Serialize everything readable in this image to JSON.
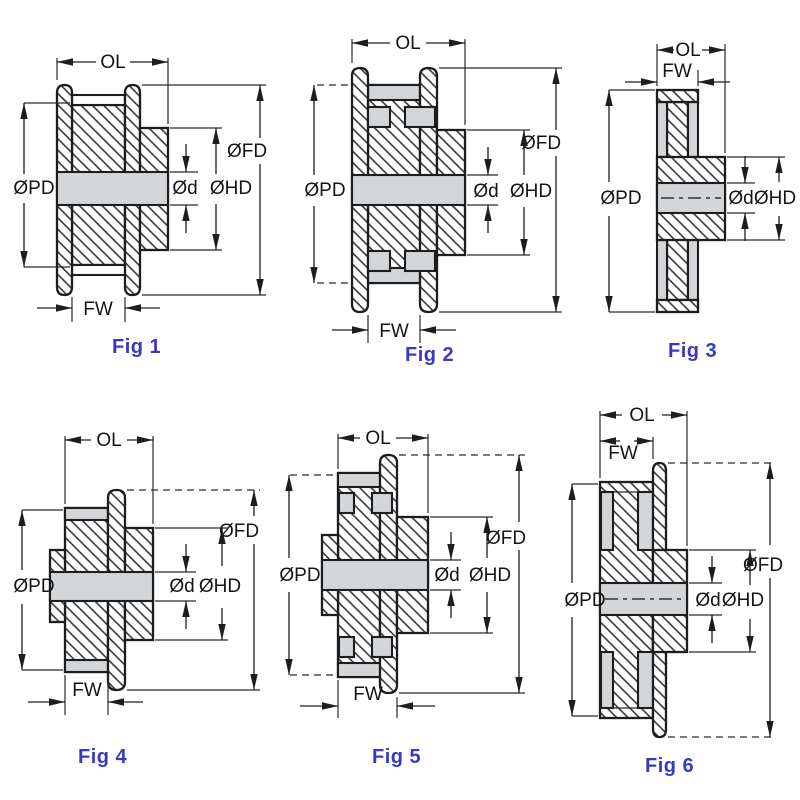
{
  "sheet": {
    "description": "Timing pulley cross-section dimension figures",
    "background": "#ffffff"
  },
  "colors": {
    "line": "#1d1d1d",
    "grey_fill": "#d3d6d9",
    "caption_blue": "#3838c4",
    "hatch": "#2b2b2b"
  },
  "dimension_labels": {
    "overall_length": "OL",
    "face_width": "FW",
    "pitch_diameter": "ØPD",
    "flange_diameter": "ØFD",
    "hub_diameter": "ØHD",
    "bore_diameter": "Ød"
  },
  "figures": [
    {
      "caption": "Fig 1",
      "labels": {
        "ol": "OL",
        "fw": "FW",
        "pd": "ØPD",
        "fd": "ØFD",
        "hd": "ØHD",
        "d": "Ød"
      }
    },
    {
      "caption": "Fig 2",
      "labels": {
        "ol": "OL",
        "fw": "FW",
        "pd": "ØPD",
        "fd": "ØFD",
        "hd": "ØHD",
        "d": "Ød"
      }
    },
    {
      "caption": "Fig 3",
      "labels": {
        "ol": "OL",
        "fw": "FW",
        "pd": "ØPD",
        "hd": "ØHD",
        "d": "Ød"
      }
    },
    {
      "caption": "Fig 4",
      "labels": {
        "ol": "OL",
        "fw": "FW",
        "pd": "ØPD",
        "fd": "ØFD",
        "hd": "ØHD",
        "d": "Ød"
      }
    },
    {
      "caption": "Fig 5",
      "labels": {
        "ol": "OL",
        "fw": "FW",
        "pd": "ØPD",
        "fd": "ØFD",
        "hd": "ØHD",
        "d": "Ød"
      }
    },
    {
      "caption": "Fig 6",
      "labels": {
        "ol": "OL",
        "fw": "FW",
        "pd": "ØPD",
        "fd": "ØFD",
        "hd": "ØHD",
        "d": "Ød"
      }
    }
  ]
}
